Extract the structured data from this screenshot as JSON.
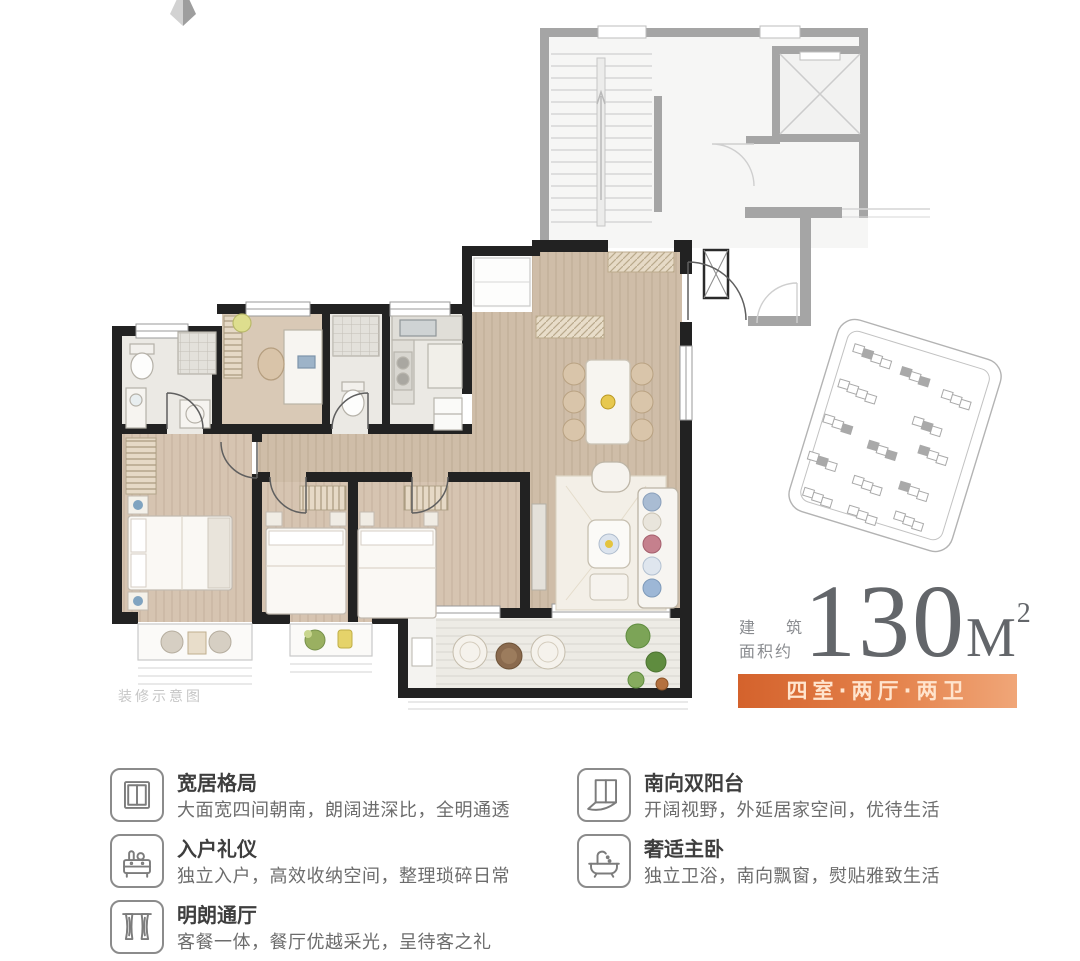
{
  "colors": {
    "accent_orange_dark": "#d4622c",
    "accent_orange_light": "#f0a678",
    "banner_text": "#ffe4cd",
    "wall_black": "#222222",
    "wood_floor": "#cfbda8",
    "bedroom_floor": "#d6c4b1",
    "tile_floor": "#ebe9e4",
    "common_area_gray": "#a5a5a5",
    "area_number_gray": "#63666a",
    "feature_title_gray": "#3e3e3e",
    "feature_desc_gray": "#6c6c6c",
    "watermark_gray": "#c6c6c6"
  },
  "area": {
    "label_line1": "建筑",
    "label_line2": "面积约",
    "value": "130",
    "unit": "M",
    "superscript": "2"
  },
  "banner": {
    "label": "四室·两厅·两卫"
  },
  "plan": {
    "watermark": "装修示意图"
  },
  "features": {
    "left": [
      {
        "icon": "window-icon",
        "title": "宽居格局",
        "desc": "大面宽四间朝南，朗阔进深比，全明通透"
      },
      {
        "icon": "console-icon",
        "title": "入户礼仪",
        "desc": "独立入户，高效收纳空间，整理琐碎日常"
      },
      {
        "icon": "curtain-icon",
        "title": "明朗通厅",
        "desc": "客餐一体，餐厅优越采光，呈待客之礼"
      }
    ],
    "right": [
      {
        "icon": "balcony-icon",
        "title": "南向双阳台",
        "desc": "开阔视野，外延居家空间，优待生活"
      },
      {
        "icon": "bathtub-icon",
        "title": "奢适主卧",
        "desc": "独立卫浴，南向飘窗，熨贴雅致生活"
      }
    ]
  }
}
